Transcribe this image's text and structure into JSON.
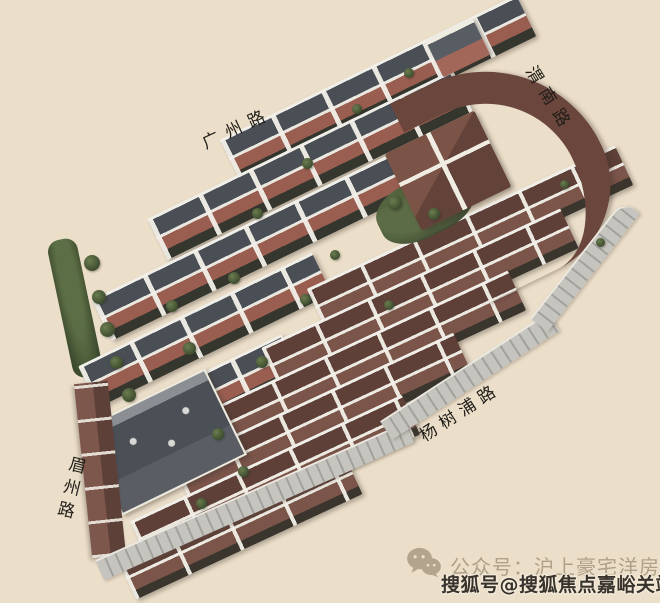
{
  "roads": [
    {
      "label": "广州路",
      "position": "top"
    },
    {
      "label": "渭南路",
      "position": "top-right"
    },
    {
      "label": "杨树浦路",
      "position": "bottom-right"
    },
    {
      "label": "眉州路",
      "position": "left"
    }
  ],
  "watermarks": {
    "faint": {
      "icon": "wechat-icon",
      "text": "公众号：沪上豪宅洋房"
    },
    "bold": {
      "text": "搜狐号@搜狐焦点嘉峪关站"
    }
  },
  "colors": {
    "background": "#ecdfca",
    "slate_roof": "#4a4e55",
    "brown_roof": "#6b463c",
    "brick_wall": "#9a5e51",
    "trim_white": "#efece2",
    "greenery": "#3e4c2e",
    "sidewalk": "#c6c4bf",
    "road_label_text": "#201d18",
    "watermark_faint": "#9e8e73",
    "watermark_bold": "#37322c"
  }
}
